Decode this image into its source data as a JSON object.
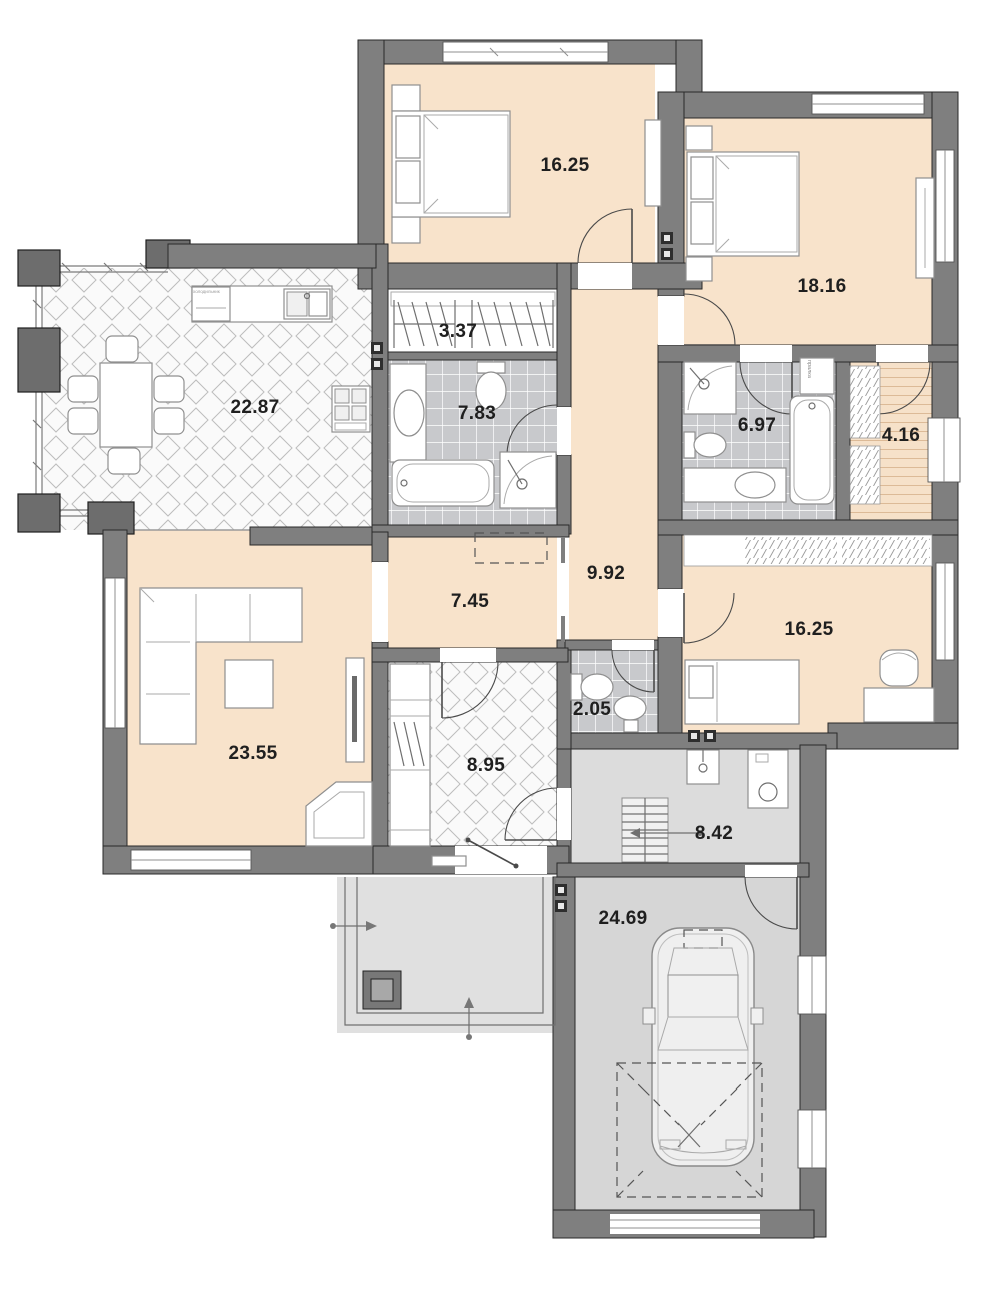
{
  "plan": {
    "type": "floor-plan",
    "rooms": {
      "bedroom_top": {
        "area": "16.25"
      },
      "bedroom_right": {
        "area": "18.16"
      },
      "kitchen_dining": {
        "area": "22.87"
      },
      "wardrobe": {
        "area": "3.37"
      },
      "bathroom_main": {
        "area": "7.83"
      },
      "bathroom_second": {
        "area": "6.97"
      },
      "sauna": {
        "area": "4.16"
      },
      "corridor": {
        "area": "9.92"
      },
      "hall": {
        "area": "7.45"
      },
      "bedroom_bottom": {
        "area": "16.25"
      },
      "wc": {
        "area": "2.05"
      },
      "living_room": {
        "area": "23.55"
      },
      "entrance_hall": {
        "area": "8.95"
      },
      "utility": {
        "area": "8.42"
      },
      "garage": {
        "area": "24.69"
      }
    },
    "annotations": {
      "washer": "пралка",
      "fridge": "холодильник"
    },
    "colors": {
      "wall": "#7f7f7f",
      "room_fill": "#f8e3cb",
      "service_fill": "#d6d6d6",
      "tile_fill": "#c8c9cc",
      "label_text": "#1f1f1f"
    }
  }
}
